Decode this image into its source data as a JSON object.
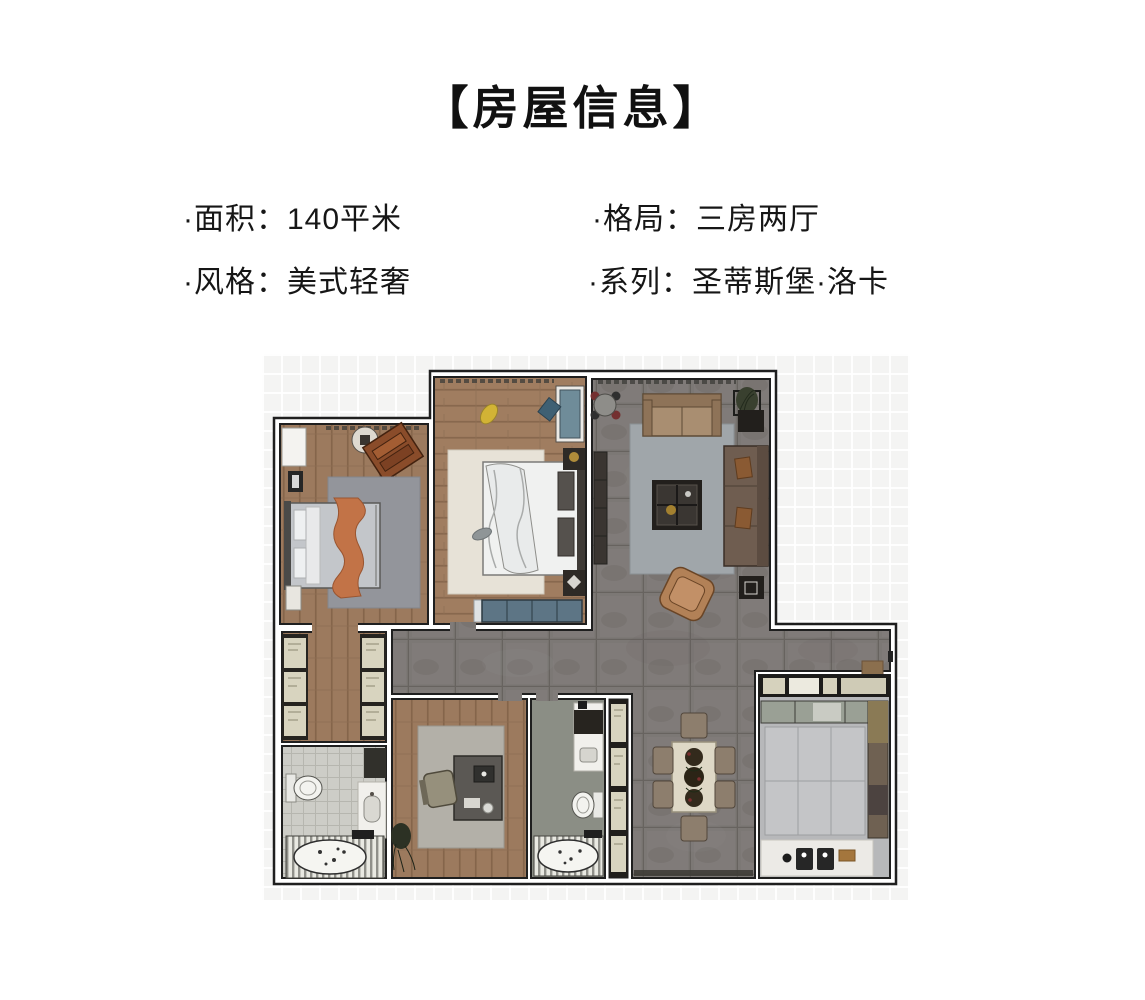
{
  "header": {
    "title": "【房屋信息】"
  },
  "info": {
    "items": [
      {
        "key": "area",
        "text": "·面积：140平米"
      },
      {
        "key": "layout",
        "text": "·格局：三房两厅"
      },
      {
        "key": "style",
        "text": "·风格：美式轻奢"
      },
      {
        "key": "series",
        "text": "·系列：圣蒂斯堡·洛卡"
      }
    ]
  },
  "palette": {
    "text": "#111111",
    "background": "#ffffff",
    "grid_background": "#f4f4f3",
    "wall_outline": "#1f1f1f",
    "wood_floor": "#9c7a5e",
    "tile_floor": "#7c7875",
    "kitchen_floor": "#b7b8ba",
    "bathroom_floor": "#cdcdc7",
    "bathroom2_floor": "#8b8e85",
    "rug_gray": "#93959b",
    "rug_cream": "#e7e2d7",
    "rug_blue_gray": "#a0a6aa",
    "sofa_tan": "#a98e71",
    "sofa_dark_brown": "#6f5d50",
    "accent_orange": "#c27347",
    "bench_teal": "#5d7585",
    "cabinet_beige": "#d8d4bf"
  }
}
